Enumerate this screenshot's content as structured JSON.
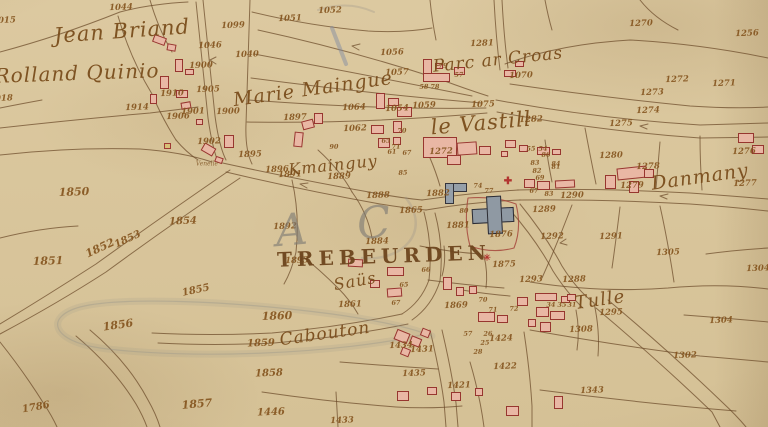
{
  "palette": {
    "paper": "#dcc9a0",
    "ink": "#6b4a28",
    "redline": "#a23f36",
    "building_fill": "#e9b7a4",
    "building_stroke": "#97362f",
    "public_fill": "#8f99a3",
    "number_color": "#85551f",
    "label_color": "#7a4d1c",
    "pencil": "#97938a",
    "blue_pencil": "#7c88a2",
    "symbol_red": "#b23530"
  },
  "map": {
    "place_names": [
      {
        "text": "Jean Briand",
        "x": 122,
        "y": 31,
        "s": 21,
        "rot": -4,
        "style": "script"
      },
      {
        "text": "Rolland Quinio",
        "x": 77,
        "y": 73,
        "s": 20,
        "rot": -2,
        "style": "script"
      },
      {
        "text": "Marie Maingue",
        "x": 313,
        "y": 89,
        "s": 19,
        "rot": -8,
        "style": "script"
      },
      {
        "text": "Parc ar Croas",
        "x": 498,
        "y": 60,
        "s": 17,
        "rot": -6,
        "style": "script"
      },
      {
        "text": "le Vastill",
        "x": 481,
        "y": 123,
        "s": 21,
        "rot": -5,
        "style": "script"
      },
      {
        "text": "Kmainguy",
        "x": 333,
        "y": 165,
        "s": 16,
        "rot": -6,
        "style": "script"
      },
      {
        "text": "TREBEURDEN",
        "x": 384,
        "y": 256,
        "s": 20,
        "rot": -2,
        "style": "caps"
      },
      {
        "text": "Saüs",
        "x": 355,
        "y": 281,
        "s": 16,
        "rot": -10,
        "style": "script"
      },
      {
        "text": "Cabouton",
        "x": 325,
        "y": 334,
        "s": 17,
        "rot": -8,
        "style": "script"
      },
      {
        "text": "Tulle",
        "x": 600,
        "y": 300,
        "s": 18,
        "rot": -8,
        "style": "script"
      },
      {
        "text": "Danmany",
        "x": 700,
        "y": 177,
        "s": 19,
        "rot": -8,
        "style": "script"
      },
      {
        "text": "Venelle",
        "x": 207,
        "y": 164,
        "s": 6,
        "rot": 0,
        "style": "tiny"
      },
      {
        "text": "A C",
        "x": 342,
        "y": 226,
        "s": 44,
        "rot": -5,
        "style": "pencil"
      }
    ],
    "parcel_numbers": [
      {
        "n": "1044",
        "x": 121,
        "y": 8
      },
      {
        "n": "1015",
        "x": 4,
        "y": 21
      },
      {
        "n": "1099",
        "x": 233,
        "y": 26
      },
      {
        "n": "1046",
        "x": 210,
        "y": 46
      },
      {
        "n": "1040",
        "x": 247,
        "y": 55
      },
      {
        "n": "1900",
        "x": 201,
        "y": 66
      },
      {
        "n": "1905",
        "x": 208,
        "y": 90
      },
      {
        "n": "1910",
        "x": 172,
        "y": 94
      },
      {
        "n": "1914",
        "x": 137,
        "y": 108
      },
      {
        "n": "1901",
        "x": 193,
        "y": 112
      },
      {
        "n": "1900",
        "x": 228,
        "y": 112
      },
      {
        "n": "1906",
        "x": 178,
        "y": 117
      },
      {
        "n": "1902",
        "x": 209,
        "y": 142
      },
      {
        "n": "1895",
        "x": 250,
        "y": 155
      },
      {
        "n": "1896",
        "x": 277,
        "y": 170
      },
      {
        "n": "1891",
        "x": 290,
        "y": 175
      },
      {
        "n": "1018",
        "x": 1,
        "y": 99
      },
      {
        "n": "1850",
        "x": 74,
        "y": 192,
        "s": 11
      },
      {
        "n": "1854",
        "x": 183,
        "y": 222,
        "s": 10
      },
      {
        "n": "1853",
        "x": 128,
        "y": 240,
        "s": 10,
        "rot": -25
      },
      {
        "n": "1852",
        "x": 100,
        "y": 248,
        "s": 11,
        "rot": -25
      },
      {
        "n": "1851",
        "x": 48,
        "y": 261,
        "s": 11
      },
      {
        "n": "1855",
        "x": 196,
        "y": 291,
        "s": 10,
        "rot": -12
      },
      {
        "n": "1856",
        "x": 118,
        "y": 325,
        "s": 11,
        "rot": -8
      },
      {
        "n": "1857",
        "x": 197,
        "y": 404,
        "s": 11,
        "rot": -5
      },
      {
        "n": "1786",
        "x": 36,
        "y": 408,
        "s": 10,
        "rot": -10
      },
      {
        "n": "1051",
        "x": 290,
        "y": 19
      },
      {
        "n": "1052",
        "x": 330,
        "y": 11
      },
      {
        "n": "1056",
        "x": 392,
        "y": 53
      },
      {
        "n": "1057",
        "x": 397,
        "y": 73
      },
      {
        "n": "1897",
        "x": 295,
        "y": 118
      },
      {
        "n": "1064",
        "x": 354,
        "y": 108
      },
      {
        "n": "1054",
        "x": 397,
        "y": 109
      },
      {
        "n": "1062",
        "x": 355,
        "y": 129
      },
      {
        "n": "1059",
        "x": 424,
        "y": 106
      },
      {
        "n": "1281",
        "x": 482,
        "y": 44
      },
      {
        "n": "1070",
        "x": 521,
        "y": 76
      },
      {
        "n": "1270",
        "x": 641,
        "y": 24
      },
      {
        "n": "1256",
        "x": 747,
        "y": 34
      },
      {
        "n": "1272",
        "x": 677,
        "y": 80
      },
      {
        "n": "1271",
        "x": 724,
        "y": 84
      },
      {
        "n": "1273",
        "x": 652,
        "y": 93
      },
      {
        "n": "1274",
        "x": 648,
        "y": 111
      },
      {
        "n": "1275",
        "x": 621,
        "y": 124
      },
      {
        "n": "1282",
        "x": 531,
        "y": 120
      },
      {
        "n": "1075",
        "x": 483,
        "y": 105
      },
      {
        "n": "1276",
        "x": 744,
        "y": 152
      },
      {
        "n": "1280",
        "x": 611,
        "y": 156
      },
      {
        "n": "1278",
        "x": 648,
        "y": 167
      },
      {
        "n": "1277",
        "x": 745,
        "y": 184
      },
      {
        "n": "1279",
        "x": 632,
        "y": 186
      },
      {
        "n": "58",
        "x": 424,
        "y": 87
      },
      {
        "n": "78",
        "x": 435,
        "y": 87
      },
      {
        "n": "79",
        "x": 443,
        "y": 66
      },
      {
        "n": "57",
        "x": 459,
        "y": 75
      },
      {
        "n": "71",
        "x": 396,
        "y": 147
      },
      {
        "n": "90",
        "x": 334,
        "y": 147
      },
      {
        "n": "65",
        "x": 386,
        "y": 141
      },
      {
        "n": "70",
        "x": 402,
        "y": 131
      },
      {
        "n": "67",
        "x": 407,
        "y": 153
      },
      {
        "n": "61",
        "x": 392,
        "y": 152
      },
      {
        "n": "85",
        "x": 403,
        "y": 173
      },
      {
        "n": "83",
        "x": 535,
        "y": 163
      },
      {
        "n": "84",
        "x": 556,
        "y": 164
      },
      {
        "n": "86",
        "x": 546,
        "y": 155
      },
      {
        "n": "82",
        "x": 537,
        "y": 171
      },
      {
        "n": "69",
        "x": 540,
        "y": 178
      },
      {
        "n": "81",
        "x": 556,
        "y": 167
      },
      {
        "n": "54",
        "x": 543,
        "y": 149
      },
      {
        "n": "55",
        "x": 531,
        "y": 149
      },
      {
        "n": "1272",
        "x": 441,
        "y": 152
      },
      {
        "n": "1882",
        "x": 438,
        "y": 194
      },
      {
        "n": "1888",
        "x": 378,
        "y": 196
      },
      {
        "n": "1865",
        "x": 411,
        "y": 211
      },
      {
        "n": "1881",
        "x": 458,
        "y": 226
      },
      {
        "n": "80",
        "x": 464,
        "y": 211
      },
      {
        "n": "74",
        "x": 478,
        "y": 186
      },
      {
        "n": "77",
        "x": 489,
        "y": 191
      },
      {
        "n": "1876",
        "x": 501,
        "y": 235
      },
      {
        "n": "1875",
        "x": 504,
        "y": 265
      },
      {
        "n": "1884",
        "x": 377,
        "y": 242
      },
      {
        "n": "1889",
        "x": 339,
        "y": 177
      },
      {
        "n": "1892",
        "x": 285,
        "y": 227
      },
      {
        "n": "1893",
        "x": 297,
        "y": 261
      },
      {
        "n": "67",
        "x": 534,
        "y": 191
      },
      {
        "n": "83",
        "x": 549,
        "y": 194
      },
      {
        "n": "1290",
        "x": 572,
        "y": 196
      },
      {
        "n": "1289",
        "x": 544,
        "y": 210
      },
      {
        "n": "1292",
        "x": 552,
        "y": 237
      },
      {
        "n": "1291",
        "x": 611,
        "y": 237
      },
      {
        "n": "1305",
        "x": 668,
        "y": 253
      },
      {
        "n": "1304",
        "x": 758,
        "y": 269
      },
      {
        "n": "1288",
        "x": 574,
        "y": 280
      },
      {
        "n": "1293",
        "x": 531,
        "y": 280
      },
      {
        "n": "1295",
        "x": 611,
        "y": 313
      },
      {
        "n": "1308",
        "x": 581,
        "y": 330
      },
      {
        "n": "1304",
        "x": 721,
        "y": 321
      },
      {
        "n": "1302",
        "x": 685,
        "y": 356
      },
      {
        "n": "1343",
        "x": 592,
        "y": 391
      },
      {
        "n": "34",
        "x": 551,
        "y": 305
      },
      {
        "n": "35",
        "x": 562,
        "y": 305
      },
      {
        "n": "31",
        "x": 572,
        "y": 305
      },
      {
        "n": "66",
        "x": 426,
        "y": 270
      },
      {
        "n": "65",
        "x": 404,
        "y": 285
      },
      {
        "n": "67",
        "x": 396,
        "y": 303
      },
      {
        "n": "1861",
        "x": 350,
        "y": 305
      },
      {
        "n": "1869",
        "x": 456,
        "y": 306
      },
      {
        "n": "70",
        "x": 483,
        "y": 300
      },
      {
        "n": "71",
        "x": 493,
        "y": 310
      },
      {
        "n": "72",
        "x": 514,
        "y": 309
      },
      {
        "n": "26",
        "x": 488,
        "y": 334
      },
      {
        "n": "25",
        "x": 485,
        "y": 343
      },
      {
        "n": "28",
        "x": 478,
        "y": 352
      },
      {
        "n": "57",
        "x": 468,
        "y": 334
      },
      {
        "n": "1424",
        "x": 501,
        "y": 339
      },
      {
        "n": "1422",
        "x": 505,
        "y": 367
      },
      {
        "n": "1421",
        "x": 459,
        "y": 386
      },
      {
        "n": "1435",
        "x": 414,
        "y": 374
      },
      {
        "n": "1431",
        "x": 422,
        "y": 350
      },
      {
        "n": "1434",
        "x": 401,
        "y": 346
      },
      {
        "n": "1433",
        "x": 342,
        "y": 421
      },
      {
        "n": "1446",
        "x": 271,
        "y": 413,
        "s": 10
      },
      {
        "n": "1860",
        "x": 277,
        "y": 316,
        "s": 11
      },
      {
        "n": "1859",
        "x": 261,
        "y": 344,
        "s": 10
      },
      {
        "n": "1858",
        "x": 269,
        "y": 374,
        "s": 10
      }
    ],
    "buildings": [
      {
        "x": 153,
        "y": 36,
        "w": 13,
        "h": 8,
        "rot": 20
      },
      {
        "x": 167,
        "y": 44,
        "w": 9,
        "h": 7,
        "rot": 10
      },
      {
        "x": 175,
        "y": 59,
        "w": 8,
        "h": 13
      },
      {
        "x": 185,
        "y": 69,
        "w": 9,
        "h": 6
      },
      {
        "x": 160,
        "y": 76,
        "w": 9,
        "h": 13
      },
      {
        "x": 176,
        "y": 90,
        "w": 12,
        "h": 8
      },
      {
        "x": 150,
        "y": 94,
        "w": 7,
        "h": 10
      },
      {
        "x": 181,
        "y": 102,
        "w": 10,
        "h": 7,
        "rot": -10
      },
      {
        "x": 196,
        "y": 119,
        "w": 7,
        "h": 6
      },
      {
        "x": 164,
        "y": 143,
        "w": 7,
        "h": 6,
        "t": "y"
      },
      {
        "x": 302,
        "y": 120,
        "w": 12,
        "h": 9,
        "rot": -15
      },
      {
        "x": 314,
        "y": 113,
        "w": 9,
        "h": 11
      },
      {
        "x": 294,
        "y": 132,
        "w": 9,
        "h": 15,
        "rot": 6
      },
      {
        "x": 224,
        "y": 135,
        "w": 10,
        "h": 13
      },
      {
        "x": 202,
        "y": 145,
        "w": 13,
        "h": 9,
        "rot": 30
      },
      {
        "x": 215,
        "y": 157,
        "w": 8,
        "h": 6,
        "rot": 20
      },
      {
        "x": 423,
        "y": 59,
        "w": 9,
        "h": 21
      },
      {
        "x": 423,
        "y": 73,
        "w": 27,
        "h": 9
      },
      {
        "x": 435,
        "y": 63,
        "w": 8,
        "h": 6
      },
      {
        "x": 454,
        "y": 67,
        "w": 11,
        "h": 8
      },
      {
        "x": 504,
        "y": 70,
        "w": 12,
        "h": 7
      },
      {
        "x": 515,
        "y": 61,
        "w": 9,
        "h": 6
      },
      {
        "x": 376,
        "y": 93,
        "w": 9,
        "h": 16
      },
      {
        "x": 388,
        "y": 98,
        "w": 11,
        "h": 8
      },
      {
        "x": 397,
        "y": 107,
        "w": 15,
        "h": 10
      },
      {
        "x": 371,
        "y": 125,
        "w": 13,
        "h": 9
      },
      {
        "x": 393,
        "y": 121,
        "w": 9,
        "h": 12
      },
      {
        "x": 378,
        "y": 138,
        "w": 12,
        "h": 10
      },
      {
        "x": 393,
        "y": 137,
        "w": 8,
        "h": 8
      },
      {
        "x": 423,
        "y": 137,
        "w": 34,
        "h": 21
      },
      {
        "x": 447,
        "y": 155,
        "w": 14,
        "h": 10
      },
      {
        "x": 457,
        "y": 142,
        "w": 20,
        "h": 13,
        "rot": -4
      },
      {
        "x": 479,
        "y": 146,
        "w": 12,
        "h": 9
      },
      {
        "x": 505,
        "y": 140,
        "w": 11,
        "h": 8
      },
      {
        "x": 519,
        "y": 145,
        "w": 9,
        "h": 7
      },
      {
        "x": 501,
        "y": 151,
        "w": 7,
        "h": 6
      },
      {
        "x": 537,
        "y": 147,
        "w": 13,
        "h": 8
      },
      {
        "x": 552,
        "y": 149,
        "w": 9,
        "h": 6
      },
      {
        "x": 445,
        "y": 183,
        "w": 22,
        "h": 9,
        "t": "p"
      },
      {
        "x": 445,
        "y": 183,
        "w": 9,
        "h": 21,
        "t": "p"
      },
      {
        "x": 472,
        "y": 208,
        "w": 42,
        "h": 15,
        "rot": -3,
        "t": "c"
      },
      {
        "x": 487,
        "y": 196,
        "w": 15,
        "h": 38,
        "rot": -3,
        "t": "c"
      },
      {
        "x": 524,
        "y": 179,
        "w": 11,
        "h": 9
      },
      {
        "x": 537,
        "y": 181,
        "w": 13,
        "h": 9
      },
      {
        "x": 555,
        "y": 180,
        "w": 20,
        "h": 8,
        "rot": -3
      },
      {
        "x": 617,
        "y": 167,
        "w": 30,
        "h": 12,
        "rot": -6
      },
      {
        "x": 605,
        "y": 175,
        "w": 11,
        "h": 14
      },
      {
        "x": 629,
        "y": 181,
        "w": 10,
        "h": 12
      },
      {
        "x": 644,
        "y": 169,
        "w": 10,
        "h": 9
      },
      {
        "x": 738,
        "y": 133,
        "w": 16,
        "h": 10
      },
      {
        "x": 752,
        "y": 145,
        "w": 12,
        "h": 9
      },
      {
        "x": 348,
        "y": 259,
        "w": 15,
        "h": 8,
        "rot": 3
      },
      {
        "x": 387,
        "y": 267,
        "w": 17,
        "h": 9
      },
      {
        "x": 370,
        "y": 280,
        "w": 10,
        "h": 8
      },
      {
        "x": 387,
        "y": 288,
        "w": 15,
        "h": 9,
        "rot": -4
      },
      {
        "x": 443,
        "y": 277,
        "w": 9,
        "h": 13
      },
      {
        "x": 456,
        "y": 287,
        "w": 8,
        "h": 9
      },
      {
        "x": 469,
        "y": 286,
        "w": 8,
        "h": 8
      },
      {
        "x": 478,
        "y": 312,
        "w": 17,
        "h": 10
      },
      {
        "x": 497,
        "y": 315,
        "w": 11,
        "h": 8
      },
      {
        "x": 517,
        "y": 297,
        "w": 11,
        "h": 9
      },
      {
        "x": 535,
        "y": 293,
        "w": 22,
        "h": 8
      },
      {
        "x": 561,
        "y": 296,
        "w": 9,
        "h": 7
      },
      {
        "x": 395,
        "y": 331,
        "w": 14,
        "h": 11,
        "rot": 22
      },
      {
        "x": 410,
        "y": 337,
        "w": 11,
        "h": 9,
        "rot": 22
      },
      {
        "x": 421,
        "y": 329,
        "w": 9,
        "h": 8,
        "rot": 22
      },
      {
        "x": 401,
        "y": 348,
        "w": 9,
        "h": 8,
        "rot": 22
      },
      {
        "x": 536,
        "y": 307,
        "w": 13,
        "h": 10
      },
      {
        "x": 550,
        "y": 311,
        "w": 15,
        "h": 9
      },
      {
        "x": 540,
        "y": 322,
        "w": 11,
        "h": 10
      },
      {
        "x": 528,
        "y": 319,
        "w": 8,
        "h": 8
      },
      {
        "x": 567,
        "y": 294,
        "w": 9,
        "h": 7
      },
      {
        "x": 397,
        "y": 391,
        "w": 12,
        "h": 10
      },
      {
        "x": 427,
        "y": 387,
        "w": 10,
        "h": 8
      },
      {
        "x": 451,
        "y": 392,
        "w": 10,
        "h": 9
      },
      {
        "x": 475,
        "y": 388,
        "w": 8,
        "h": 8
      },
      {
        "x": 506,
        "y": 406,
        "w": 13,
        "h": 10
      },
      {
        "x": 554,
        "y": 396,
        "w": 9,
        "h": 13
      }
    ],
    "symbols": [
      {
        "glyph": "✚",
        "name": "red-cross-icon",
        "x": 508,
        "y": 182,
        "s": 10
      },
      {
        "glyph": "✳",
        "name": "red-star-icon",
        "x": 487,
        "y": 259,
        "s": 9
      }
    ]
  }
}
